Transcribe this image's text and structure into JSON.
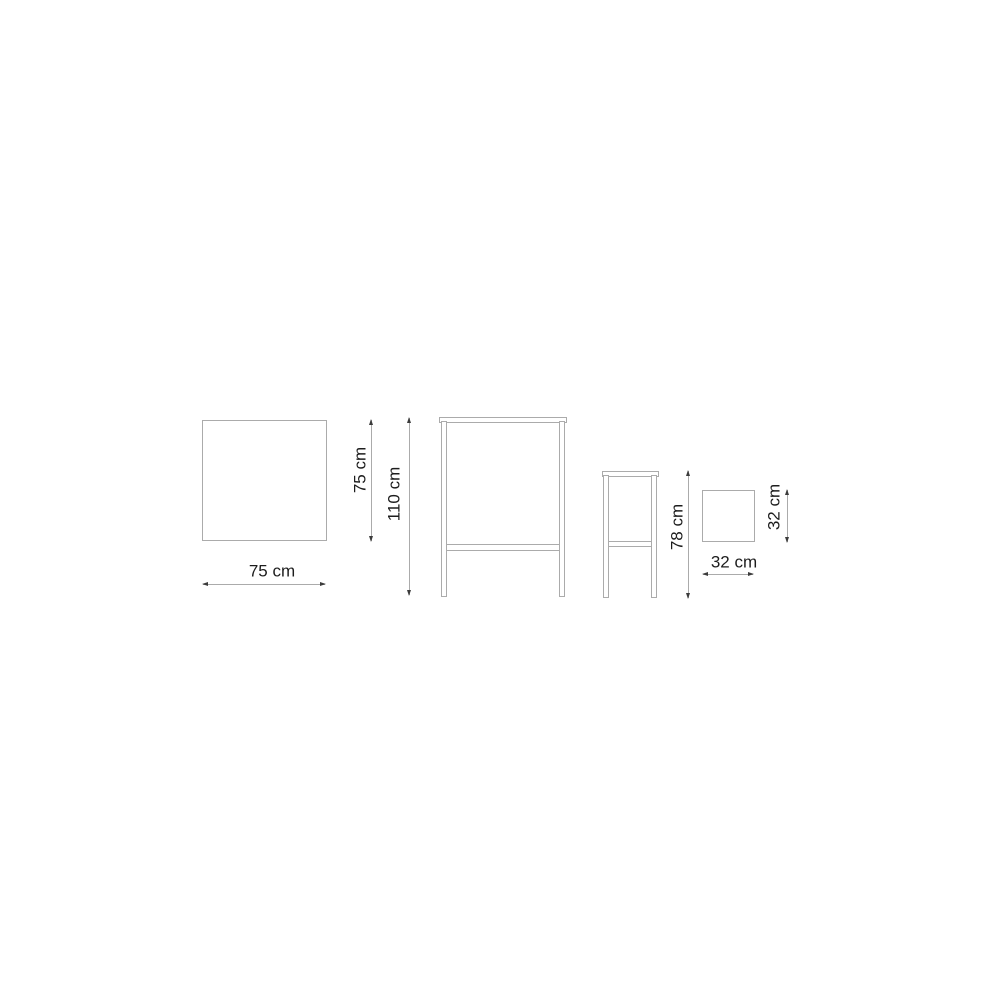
{
  "diagram": {
    "type": "furniture-dimension-drawing",
    "background": "#ffffff",
    "colors": {
      "bg": "#ffffff",
      "line": "#ababab",
      "arrow": "#3c3c3c",
      "text": "#1d1d1d"
    },
    "views": {
      "table_top": {
        "name": "table top view",
        "width_label": "75 cm",
        "depth_label": "75 cm"
      },
      "table_front": {
        "name": "high table front view",
        "height_label": "110 cm"
      },
      "stool_front": {
        "name": "stool front view",
        "height_label": "78 cm"
      },
      "stool_top": {
        "name": "stool seat top view",
        "width_label": "32 cm",
        "depth_label": "32 cm"
      }
    }
  }
}
